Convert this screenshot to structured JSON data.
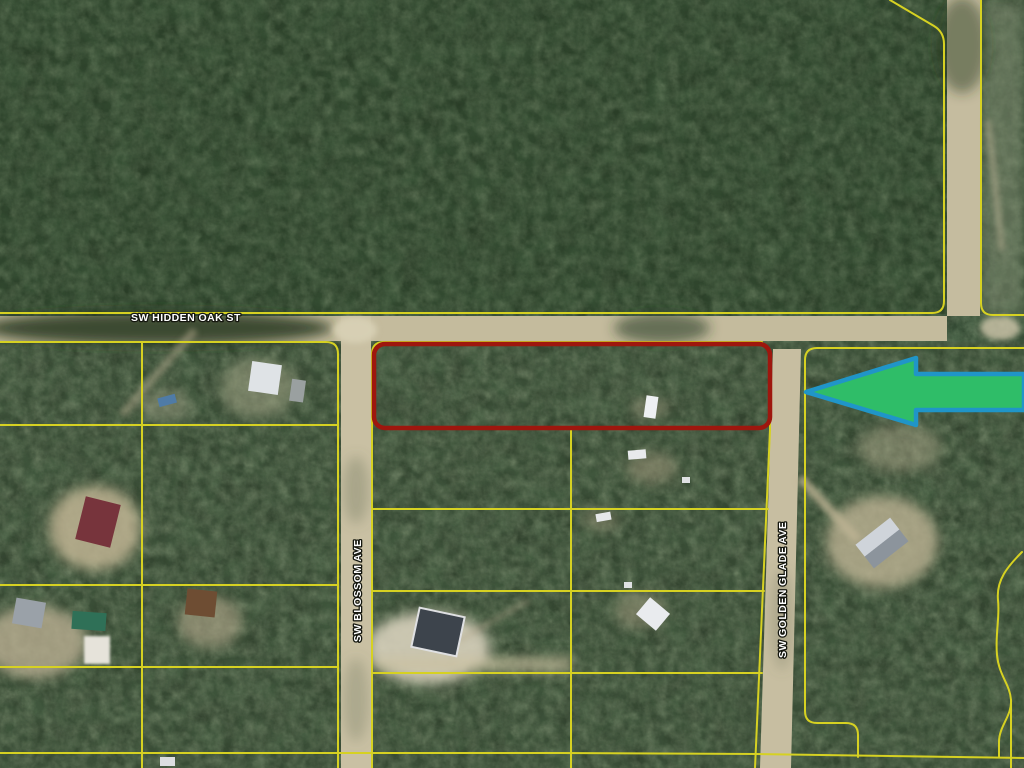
{
  "map": {
    "description": "Aerial parcel map: subject lot outlined in red on SW Hidden Oak St, green arrow pointing to it",
    "streets": {
      "hidden_oak": "SW HIDDEN OAK ST",
      "blossom": "SW BLOSSOM AVE",
      "golden_glade": "SW GOLDEN GLADE AVE"
    },
    "colors": {
      "parcel_line": "#d6d122",
      "highlight_outline": "#9e170e",
      "arrow_fill": "#2fbd68",
      "arrow_stroke": "#2095c8",
      "label_text": "#ffffff"
    }
  }
}
